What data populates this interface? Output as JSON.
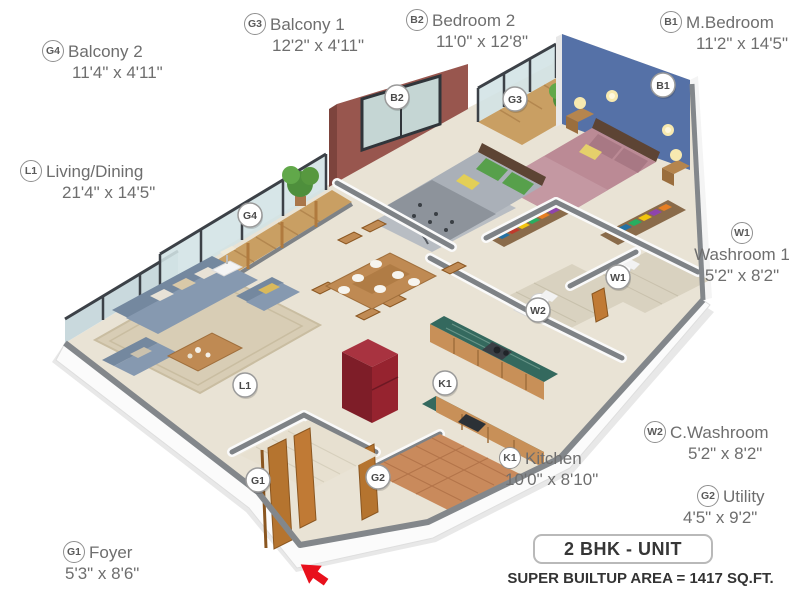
{
  "rooms": [
    {
      "code": "G4",
      "name": "Balcony 2",
      "dims": "11'4\" x 4'11\""
    },
    {
      "code": "G3",
      "name": "Balcony 1",
      "dims": "12'2\" x 4'11\""
    },
    {
      "code": "B2",
      "name": "Bedroom 2",
      "dims": "11'0\" x 12'8\""
    },
    {
      "code": "B1",
      "name": "M.Bedroom",
      "dims": "11'2\" x 14'5\""
    },
    {
      "code": "L1",
      "name": "Living/Dining",
      "dims": "21'4\" x 14'5\""
    },
    {
      "code": "W1",
      "name": "Washroom 1",
      "dims": "5'2\" x 8'2\""
    },
    {
      "code": "W2",
      "name": "C.Washroom",
      "dims": "5'2\" x 8'2\""
    },
    {
      "code": "G2",
      "name": "Utility",
      "dims": "4'5\" x 9'2\""
    },
    {
      "code": "K1",
      "name": "Kitchen",
      "dims": "10'0\" x 8'10\""
    },
    {
      "code": "G1",
      "name": "Foyer",
      "dims": "5'3\" x 8'6\""
    }
  ],
  "footer": {
    "unit_label": "2 BHK - UNIT",
    "area_label": "SUPER BUILTUP AREA = 1417 SQ.FT."
  },
  "colors": {
    "master_bedroom_wall": "#5571a7",
    "bedroom2_wall": "#98564e",
    "kitchen_counter": "#34695e",
    "balcony_wood": "#c99f63",
    "sofa": "#8699b0",
    "floor": "#e9e3d5",
    "wall_cap": "#83878b",
    "entry_arrow": "#e8101c"
  }
}
